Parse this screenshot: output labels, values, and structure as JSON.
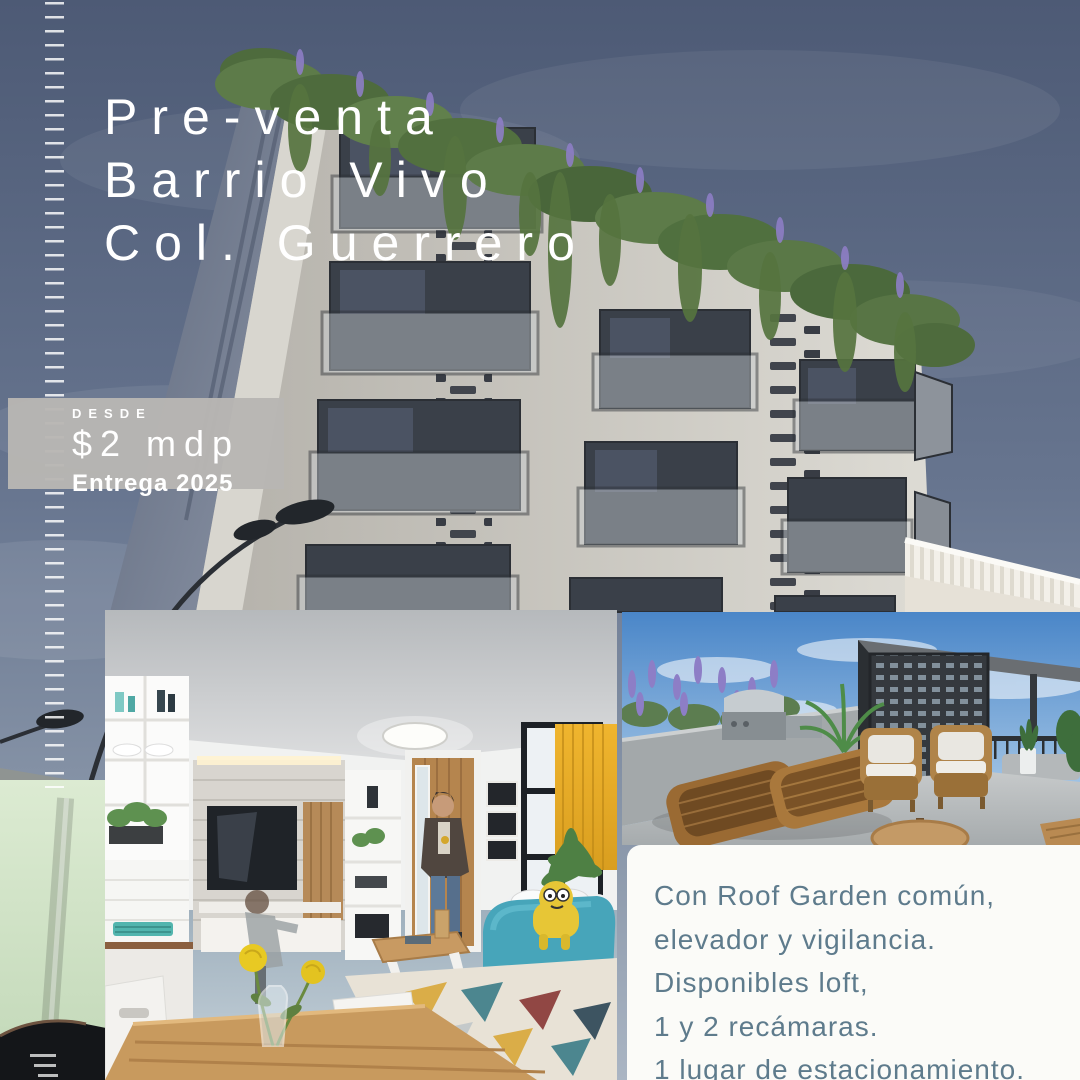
{
  "poster": {
    "title": {
      "lines": [
        "Pre-venta",
        "Barrio Vivo",
        "Col. Guerrero"
      ]
    },
    "price_badge": {
      "label": "DESDE",
      "price": "$2 mdp",
      "delivery": "Entrega 2025"
    },
    "description": {
      "lines": [
        "Con Roof Garden común,",
        "elevador y vigilancia.",
        "Disponibles loft,",
        "1 y 2 recámaras.",
        "1 lugar de estacionamiento."
      ]
    },
    "images": {
      "background": "building-exterior-render-with-roof-greenery",
      "bottom_left": "living-room-interior-render",
      "bottom_right": "roof-garden-terrace-render"
    },
    "colors": {
      "badge_bg": "#b8b6b3",
      "title_text": "#ffffff",
      "description_text": "#5e7b8c",
      "description_box_bg": "#fbfbf8",
      "sky": "#67758f",
      "facade": "#cdcac3",
      "greenery": "#5d7b49",
      "accent_teal_chair": "#47a5ba",
      "accent_yellow": "#e7c636",
      "rattan": "#a87a44"
    }
  }
}
